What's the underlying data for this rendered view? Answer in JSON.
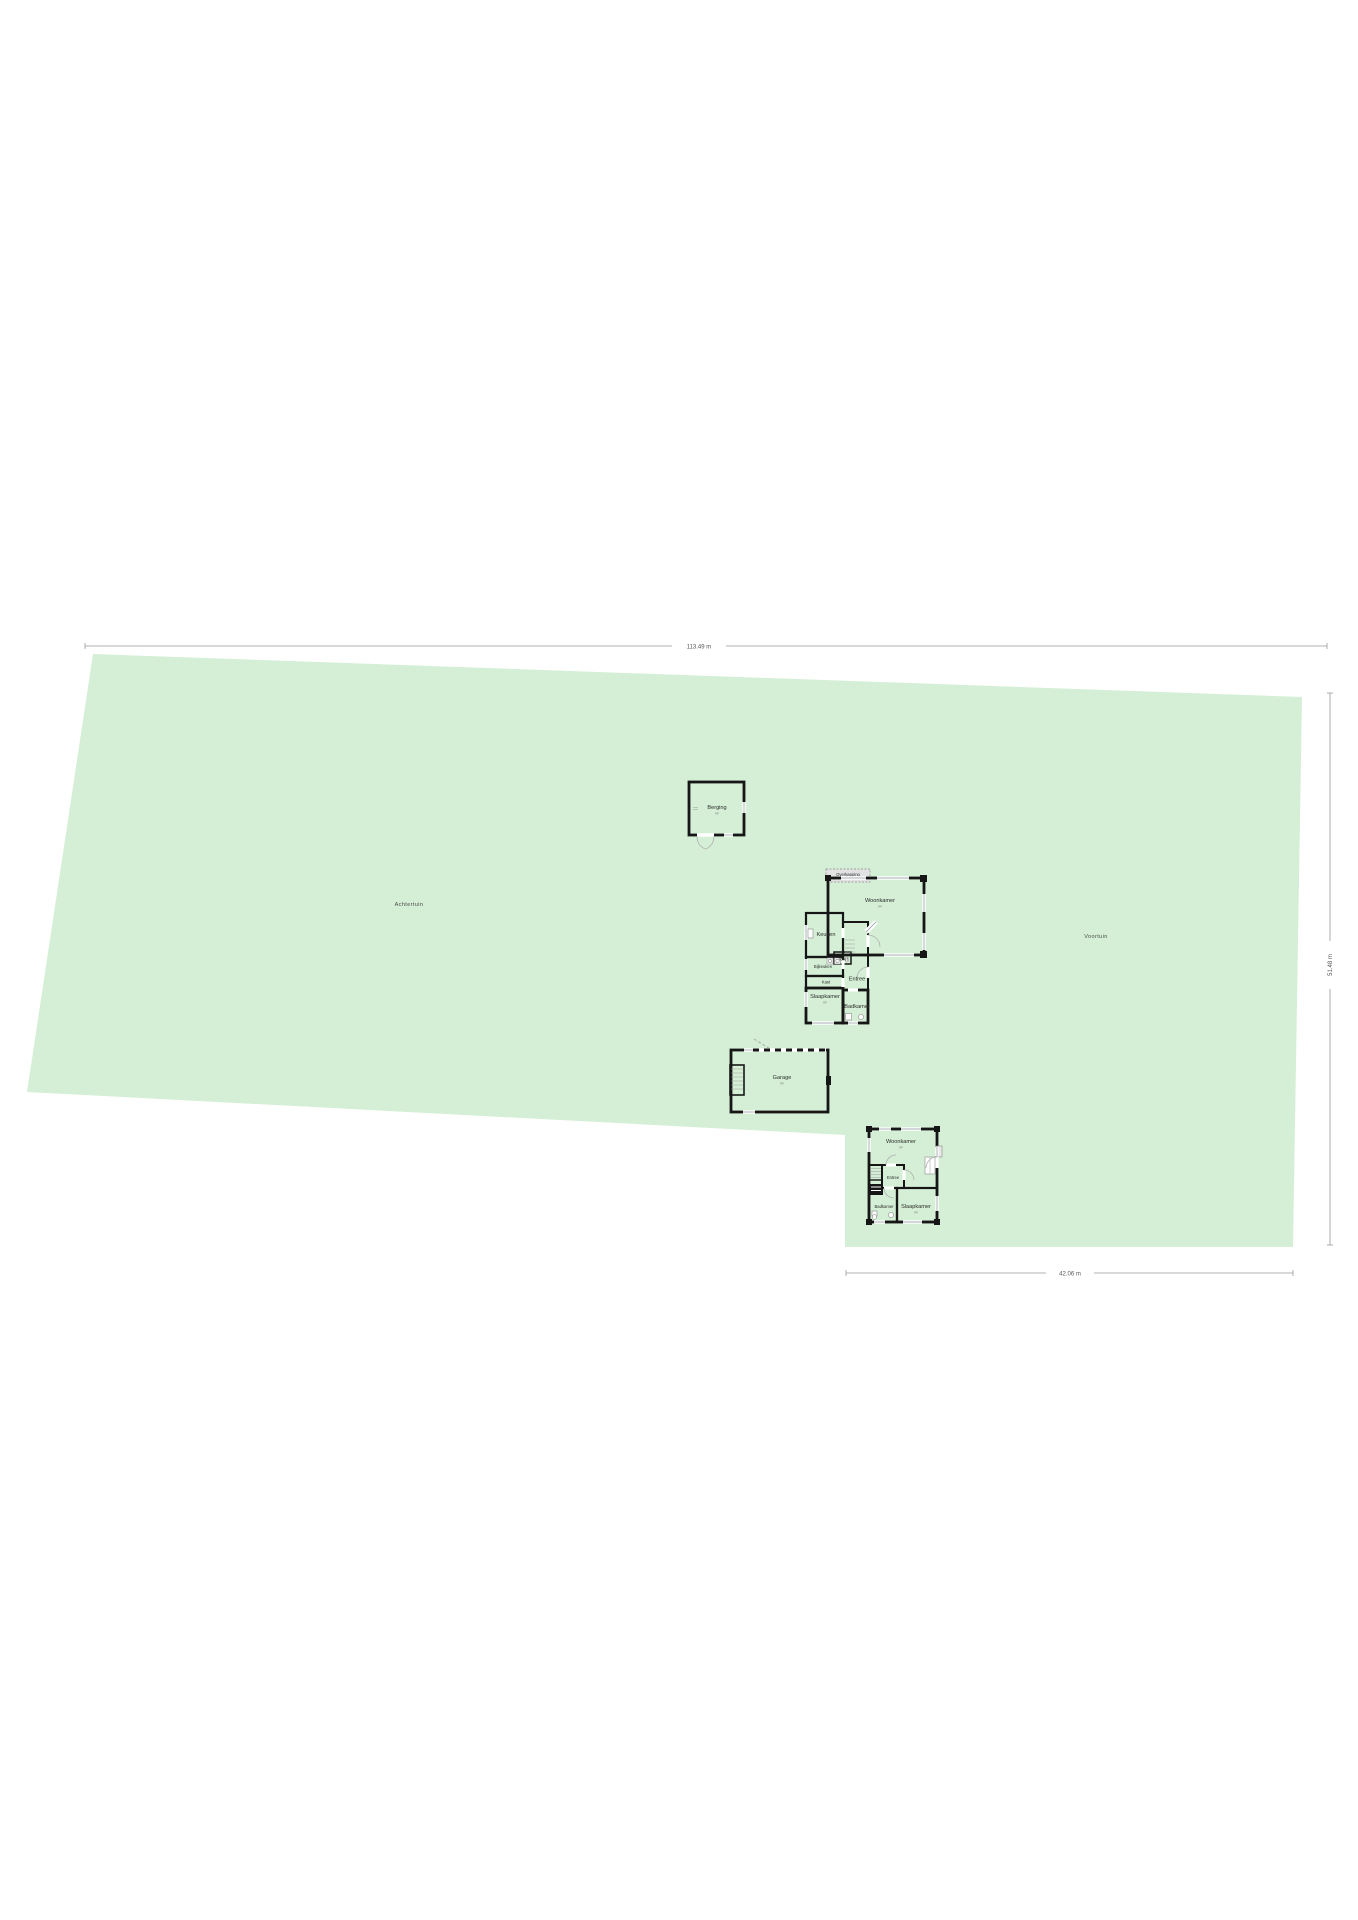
{
  "dimensions": {
    "width_top": "113.49 m",
    "depth_right": "51.48 m",
    "width_bottom": "42.06 m"
  },
  "garden": {
    "back_label": "Achtertuin",
    "front_label": "Voortuin"
  },
  "berging": {
    "label": "Berging",
    "area": "m²"
  },
  "garage": {
    "label": "Garage",
    "area": "m²"
  },
  "main_house": {
    "overkapping": "Overkapping",
    "woonkamer": "Woonkamer",
    "woonkamer_area": "m²",
    "keuken": "Keuken",
    "toilet": "Toilet",
    "bijkeuken": "Bijkeuken",
    "kast": "Kast",
    "entree": "Entree",
    "slaapkamer": "Slaapkamer",
    "slaapkamer_area": "m²",
    "badkamer": "Badkamer"
  },
  "guest_house": {
    "woonkamer": "Woonkamer",
    "woonkamer_area": "m²",
    "entree": "Entree",
    "badkamer": "Badkamer",
    "slaapkamer": "Slaapkamer",
    "slaapkamer_area": "m²"
  },
  "colors": {
    "plot_green": "#d4efd5",
    "wall": "#161616",
    "room_tan": "#ebc69b",
    "room_orange": "#f1a95e",
    "room_blue": "#cfdde9",
    "berging_brown": "#c6a283",
    "garage_grey": "#d2d2d2",
    "overkapping_grey": "#e2e2e2"
  }
}
